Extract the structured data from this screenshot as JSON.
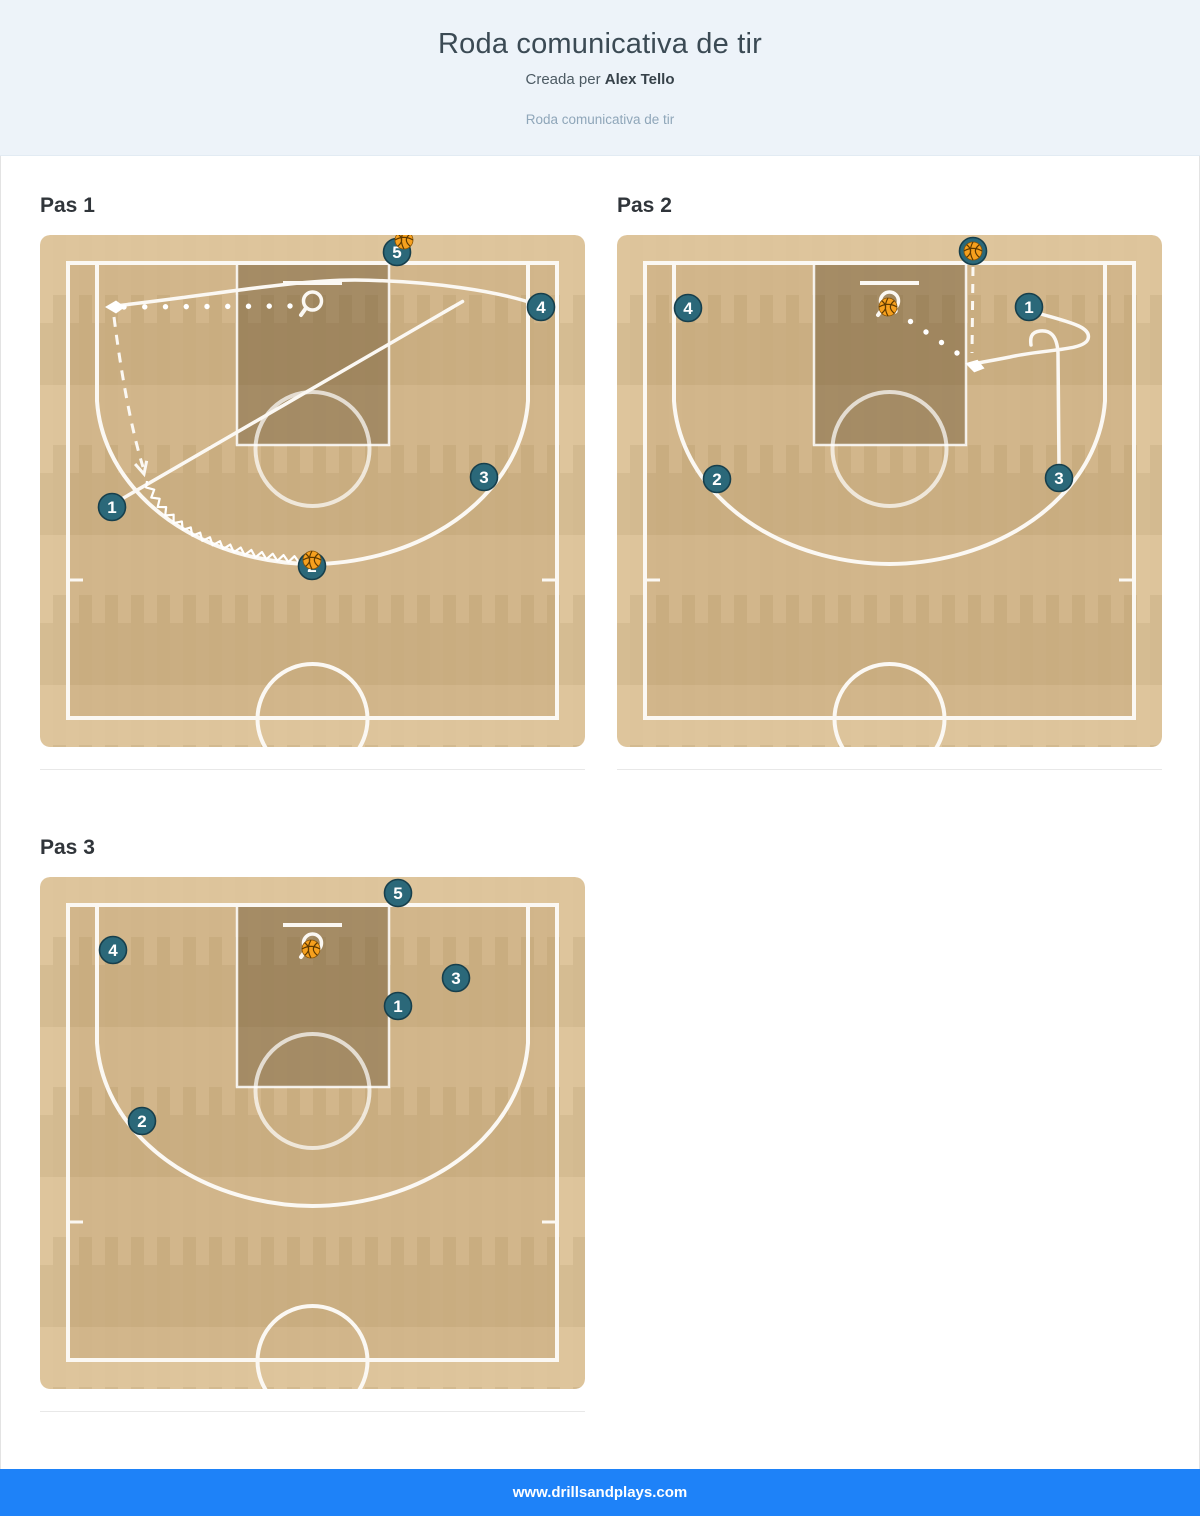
{
  "header": {
    "title": "Roda comunicativa de tir",
    "byline_prefix": "Creada per",
    "author": "Alex Tello",
    "subtitle_link": "Roda comunicativa de tir"
  },
  "footer": {
    "url": "www.drillsandplays.com"
  },
  "colors": {
    "header_bg": "#edf3f9",
    "footer_blue": "#1e82f8",
    "court_base": "#dcc297",
    "court_inner_shade": "rgba(150,105,50,0.16)",
    "key_shade": "rgba(80,58,28,0.34)",
    "court_line": "#fbf8f3",
    "token_fill": "#2b6879",
    "token_stroke": "#173f4c",
    "token_text": "#ffffff",
    "ball_fill": "#f6a01e",
    "ball_seam": "#5f3a00"
  },
  "steps": [
    {
      "title": "Pas 1",
      "players": [
        {
          "n": "1",
          "x": 72,
          "y": 272
        },
        {
          "n": "2",
          "x": 272,
          "y": 331
        },
        {
          "n": "3",
          "x": 444,
          "y": 242
        },
        {
          "n": "4",
          "x": 501,
          "y": 72
        },
        {
          "n": "5",
          "x": 357,
          "y": 17
        }
      ],
      "balls": [
        {
          "x": 364,
          "y": 5
        },
        {
          "x": 272,
          "y": 325
        }
      ],
      "paths": [
        {
          "kind": "run",
          "d": "M 74,71 C 160,62 250,45 315,45 C 392,46 458,56 498,70"
        },
        {
          "kind": "screen",
          "d": "M 80,265 L 413,72",
          "cap": [
            413,
            72,
            -30
          ]
        },
        {
          "kind": "pass",
          "from": [
            250,
            71
          ],
          "to": [
            84,
            72
          ],
          "spacing": 21
        },
        {
          "kind": "diamond",
          "at": [
            72,
            72
          ],
          "angle": 180
        },
        {
          "kind": "cut",
          "d": "M 74,82 C 80,130 90,190 103,232",
          "vee": [
            104,
            239,
            75
          ]
        },
        {
          "kind": "dribble",
          "d": "M 107,246 C 125,296 185,320 263,325"
        }
      ]
    },
    {
      "title": "Pas 2",
      "players": [
        {
          "n": "1",
          "x": 412,
          "y": 72
        },
        {
          "n": "2",
          "x": 100,
          "y": 244
        },
        {
          "n": "3",
          "x": 442,
          "y": 243
        },
        {
          "n": "4",
          "x": 71,
          "y": 73
        },
        {
          "n": "5",
          "x": 356,
          "y": 16
        }
      ],
      "balls": [
        {
          "x": 356,
          "y": 16
        },
        {
          "x": 271,
          "y": 72
        }
      ],
      "paths": [
        {
          "kind": "dash",
          "d": "M 356,32 L 355,118"
        },
        {
          "kind": "pass",
          "from": [
            278,
            76
          ],
          "to": [
            340,
            118
          ],
          "spacing": 20
        },
        {
          "kind": "run",
          "d": "M 424,79 C 452,87 475,92 471,104 C 467,116 428,114 393,122 C 378,125 366,127 361,128"
        },
        {
          "kind": "diamond",
          "at": [
            355,
            130
          ],
          "angle": 195
        },
        {
          "kind": "run",
          "d": "M 442,231 L 441,118 C 440,99 432,95 423,96 C 414,97 413,103 414,110"
        }
      ]
    },
    {
      "title": "Pas 3",
      "players": [
        {
          "n": "1",
          "x": 358,
          "y": 129
        },
        {
          "n": "2",
          "x": 102,
          "y": 244
        },
        {
          "n": "3",
          "x": 416,
          "y": 101
        },
        {
          "n": "4",
          "x": 73,
          "y": 73
        },
        {
          "n": "5",
          "x": 358,
          "y": 16
        }
      ],
      "balls": [
        {
          "x": 271,
          "y": 72
        }
      ],
      "paths": []
    }
  ]
}
